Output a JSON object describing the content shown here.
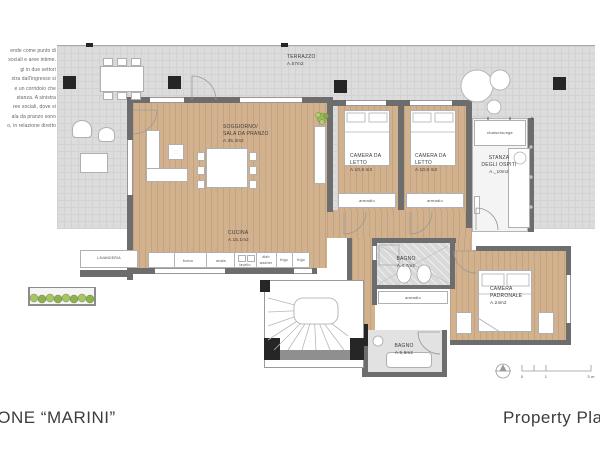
{
  "paragraph": {
    "lines": [
      "ende come punto di",
      "sociali e aree intime.",
      "gi in due settori",
      "stra dall'ingresso si",
      "e un corridoio che",
      "stanza. A sinistra",
      "ree sociali, dove si",
      "ala da pranzo sono",
      "o, in relazione diretto"
    ]
  },
  "plan": {
    "terrazzo_name": "TERRAZZO",
    "terrazzo_area": "A.57m2",
    "soggiorno_l1": "SOGGIORNO/",
    "soggiorno_l2": "SALA DA PRANZO",
    "soggiorno_area": "A.35,3m2",
    "camera1_l1": "CAMERA DA",
    "camera1_l2": "LETTO",
    "camera1_area": "A.10,6 m2",
    "camera2_l1": "CAMERA DA",
    "camera2_l2": "LETTO",
    "camera2_area": "A.10,6 m2",
    "ospiti_l1": "STANZA",
    "ospiti_l2": "DEGLI OSPITI",
    "ospiti_area": "A._10m2",
    "cucina_name": "CUCINA",
    "cucina_area": "A.15,1m2",
    "bagno1_name": "BAGNO",
    "bagno1_area": "A.4,7m2",
    "padronale_l1": "CAMERA",
    "padronale_l2": "PADRONALE",
    "padronale_area": "A.24m2",
    "bagno2_name": "BAGNO",
    "bagno2_area": "A.5,5m2",
    "lavanderia": "LAVANDERIA",
    "chaiselounge": "chaiselounge",
    "armadio": "armadio",
    "forno": "forno",
    "stufa": "stufa",
    "lavello": "lavello",
    "dish": "dish",
    "washer": "washer",
    "frigo": "frigo"
  },
  "scalebar": {
    "zero": "0",
    "one": "1",
    "three": "3 m"
  },
  "titles": {
    "left": "IONE “MARINI”",
    "right": "Property Pla"
  },
  "colors": {
    "wood": "#d2b28e",
    "terrace": "#dcdcdc",
    "wall": "#6d6d6d",
    "plant_green": "#9ab95c"
  }
}
